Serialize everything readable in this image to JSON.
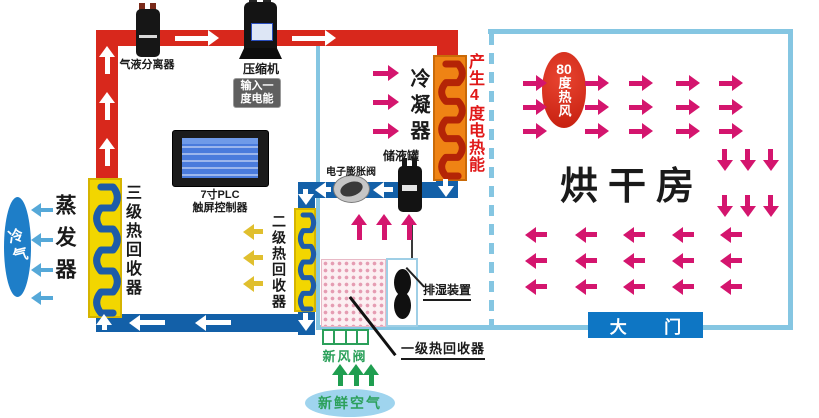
{
  "labels": {
    "separator": "气液分离器",
    "compressor": "压缩机",
    "compressor_badge": {
      "line1": "输入一",
      "line2": "度电能"
    },
    "plc": {
      "line1": "7寸PLC",
      "line2": "触屏控制器"
    },
    "evaporator": "蒸发器",
    "cold_air": "冷气",
    "stage3": "三级热回收器",
    "stage2": "二级热回收器",
    "stage1": "一级热回收器",
    "expansion_valve": "电子膨胀阀",
    "receiver": "储液罐",
    "condenser": "冷凝器",
    "heat_energy": "产生4度电热能",
    "hot_air_num": "80",
    "hot_air_rest": "度热风",
    "drying_room": "烘干房",
    "dehumidifier": "排湿装置",
    "fresh_air_valve": "新风阀",
    "fresh_air": "新鲜空气",
    "door": "大门"
  },
  "colors": {
    "white": "#ffffff",
    "red_pipe": "#d8281c",
    "blue_pipe": "#1360a8",
    "wall": "#85c6e2",
    "coil_blue": "#1e5ca8",
    "condenser_coil": "#b42406",
    "magenta": "#d4156e",
    "yellow_arrow": "#e0bf2e",
    "light_blue_arrow": "#55a8d8",
    "green": "#1f9e50",
    "cold_oval": "#1e7ec8",
    "fresh_oval": "#9fd4ee",
    "door_bg": "#0e76c4",
    "hot_oval": "#d42312",
    "red_text": "#e01818",
    "green_text": "#2ba05a"
  }
}
